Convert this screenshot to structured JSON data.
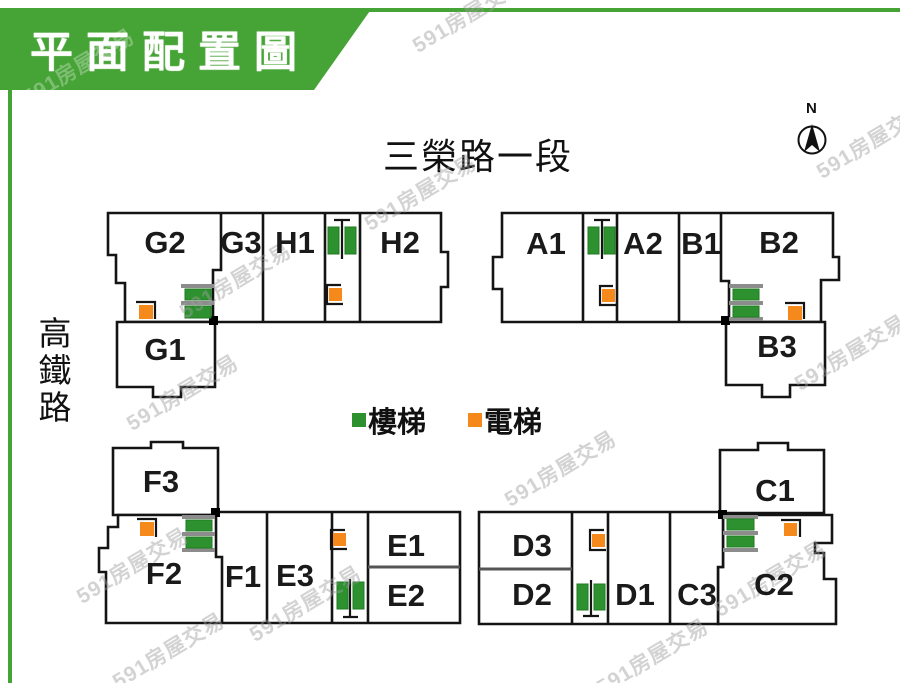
{
  "header": {
    "title": "平面配置圖"
  },
  "watermark": {
    "text": "591房屋交易"
  },
  "roads": {
    "top": "三榮路一段",
    "left": "高鐵路"
  },
  "compass": {
    "label": "N"
  },
  "legend": {
    "stairs": "樓梯",
    "elevator": "電梯"
  },
  "units": {
    "g2": "G2",
    "g3": "G3",
    "h1": "H1",
    "h2": "H2",
    "g1": "G1",
    "a1": "A1",
    "a2": "A2",
    "b1": "B1",
    "b2": "B2",
    "b3": "B3",
    "f3": "F3",
    "f2": "F2",
    "f1": "F1",
    "e3": "E3",
    "e1": "E1",
    "e2": "E2",
    "d3": "D3",
    "d2": "D2",
    "d1": "D1",
    "c3": "C3",
    "c1": "C1",
    "c2": "C2"
  },
  "colors": {
    "banner_green": "#46a336",
    "stairs_green": "#2e9130",
    "elevator_orange": "#f6891c",
    "wall_black": "#141414",
    "watermark_gray": "#9e9e9e"
  }
}
